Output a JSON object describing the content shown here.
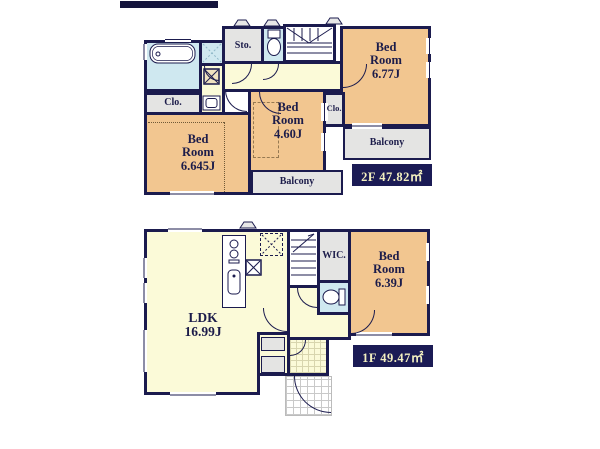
{
  "colors": {
    "wall": "#1b1b4e",
    "tan": "#f2c690",
    "cream": "#fbfad8",
    "blue": "#cfe8f0",
    "gray": "#e4e4e3",
    "labelBg": "#1b1b55",
    "labelFg": "#f3f0c0"
  },
  "floor2": {
    "area_label": "2F 47.82㎡",
    "rooms": {
      "bed677": {
        "lines": [
          "Bed",
          "Room",
          "6.77J"
        ]
      },
      "bed460": {
        "lines": [
          "Bed",
          "Room",
          "4.60J"
        ]
      },
      "bed6645": {
        "lines": [
          "Bed",
          "Room",
          "6.645J"
        ]
      },
      "storage": "Sto.",
      "closet_left": "Clo.",
      "closet_mid": "Clo.",
      "balcony_right": "Balcony",
      "balcony_bottom": "Balcony"
    }
  },
  "floor1": {
    "area_label": "1F 49.47㎡",
    "rooms": {
      "ldk": {
        "lines": [
          "LDK",
          "16.99J"
        ]
      },
      "bed639": {
        "lines": [
          "Bed",
          "Room",
          "6.39J"
        ]
      },
      "wic": "WIC."
    }
  }
}
